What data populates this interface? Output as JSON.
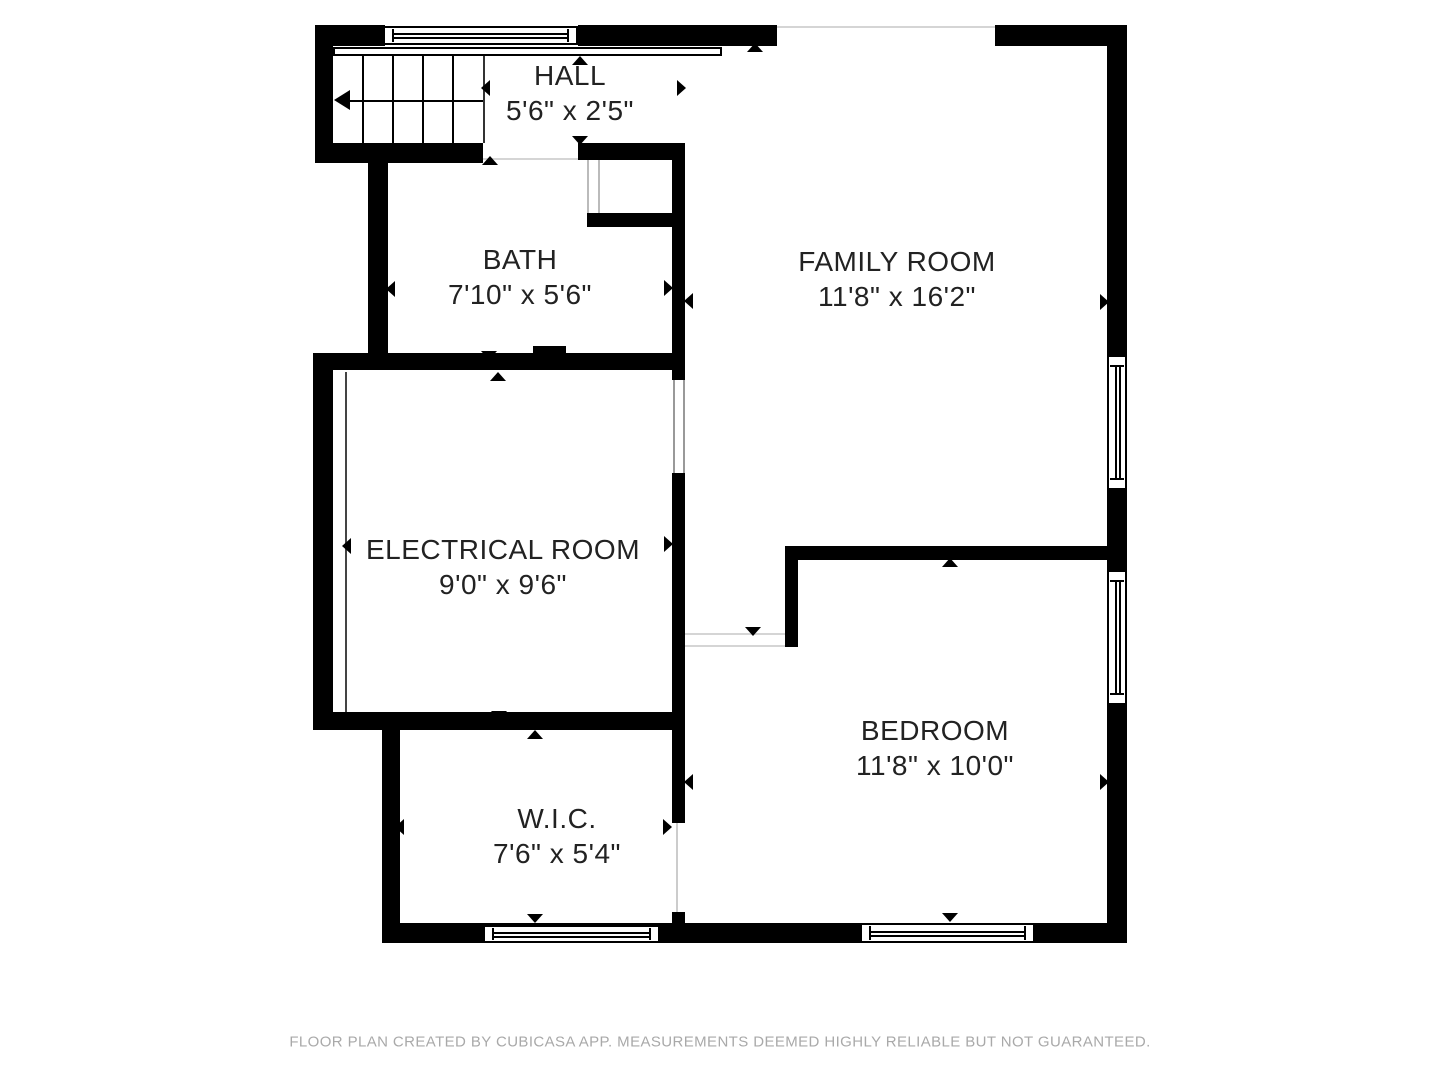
{
  "meta": {
    "wall_color": "#000000",
    "text_color": "#222222",
    "muted_text_color": "#a9a9a9",
    "faint_line_color": "#d5d5d5",
    "frame_line_color": "#999999",
    "background": "#ffffff"
  },
  "footer": {
    "text": "FLOOR PLAN CREATED BY CUBICASA APP. MEASUREMENTS DEEMED HIGHLY RELIABLE BUT NOT GUARANTEED."
  },
  "rooms": [
    {
      "id": "hall",
      "name": "HALL",
      "dims": "5'6\" x 2'5\"",
      "cx": 570,
      "cy": 93
    },
    {
      "id": "bath",
      "name": "BATH",
      "dims": "7'10\" x 5'6\"",
      "cx": 520,
      "cy": 277
    },
    {
      "id": "family-room",
      "name": "FAMILY ROOM",
      "dims": "11'8\" x 16'2\"",
      "cx": 897,
      "cy": 279
    },
    {
      "id": "electrical-room",
      "name": "ELECTRICAL ROOM",
      "dims": "9'0\" x 9'6\"",
      "cx": 503,
      "cy": 567
    },
    {
      "id": "bedroom",
      "name": "BEDROOM",
      "dims": "11'8\" x 10'0\"",
      "cx": 935,
      "cy": 748
    },
    {
      "id": "wic",
      "name": "W.I.C.",
      "dims": "7'6\" x 5'4\"",
      "cx": 557,
      "cy": 836
    }
  ],
  "walls": [
    [
      315,
      25,
      70,
      21
    ],
    [
      578,
      25,
      199,
      21
    ],
    [
      995,
      25,
      132,
      21
    ],
    [
      1107,
      25,
      20,
      330
    ],
    [
      1107,
      490,
      20,
      80
    ],
    [
      1107,
      705,
      20,
      238
    ],
    [
      382,
      923,
      745,
      20
    ],
    [
      315,
      25,
      18,
      138
    ],
    [
      315,
      143,
      168,
      20
    ],
    [
      368,
      143,
      20,
      227
    ],
    [
      313,
      353,
      364,
      17
    ],
    [
      313,
      353,
      20,
      377
    ],
    [
      313,
      712,
      364,
      18
    ],
    [
      382,
      718,
      18,
      225
    ],
    [
      578,
      143,
      107,
      17
    ],
    [
      587,
      213,
      90,
      14
    ],
    [
      672,
      145,
      13,
      235
    ],
    [
      672,
      473,
      13,
      350
    ],
    [
      672,
      912,
      13,
      11
    ],
    [
      785,
      546,
      322,
      14
    ],
    [
      785,
      546,
      13,
      101
    ],
    [
      533,
      346,
      33,
      16
    ]
  ],
  "windows": [
    {
      "rect": [
        383,
        26,
        195,
        19
      ],
      "orient": "h"
    },
    {
      "rect": [
        1107,
        355,
        20,
        135
      ],
      "orient": "v"
    },
    {
      "rect": [
        1107,
        570,
        20,
        135
      ],
      "orient": "v"
    },
    {
      "rect": [
        860,
        923,
        175,
        20
      ],
      "orient": "h"
    },
    {
      "rect": [
        483,
        925,
        177,
        18
      ],
      "orient": "h"
    }
  ],
  "thin_lines": [
    {
      "rect": [
        777,
        26,
        218,
        2
      ],
      "color": "#d5d5d5"
    },
    {
      "rect": [
        483,
        158,
        95,
        2
      ],
      "color": "#d5d5d5"
    },
    {
      "rect": [
        587,
        160,
        2,
        53
      ],
      "color": "#bbbbbb"
    },
    {
      "rect": [
        598,
        160,
        2,
        53
      ],
      "color": "#bbbbbb"
    },
    {
      "rect": [
        673,
        380,
        2,
        93
      ],
      "color": "#999999"
    },
    {
      "rect": [
        683,
        380,
        2,
        93
      ],
      "color": "#999999"
    },
    {
      "rect": [
        685,
        633,
        100,
        2
      ],
      "color": "#d5d5d5"
    },
    {
      "rect": [
        685,
        645,
        100,
        2
      ],
      "color": "#d5d5d5"
    },
    {
      "rect": [
        676,
        823,
        2,
        89
      ],
      "color": "#cccccc"
    },
    {
      "rect": [
        345,
        372,
        2,
        340
      ],
      "color": "#444444"
    },
    {
      "rect": [
        483,
        56,
        2,
        87
      ],
      "color": "#333333"
    }
  ],
  "railing": {
    "rect": [
      333,
      47,
      389,
      9
    ]
  },
  "stairs": {
    "region": [
      333,
      56,
      150,
      87
    ],
    "tread_x": [
      362,
      392,
      422,
      452
    ],
    "arrow_line": {
      "x1": 345,
      "x2": 483,
      "y": 100
    },
    "arrowhead": {
      "x": 334,
      "y": 90
    }
  },
  "arrows": [
    {
      "x": 580,
      "y": 61,
      "dir": "up"
    },
    {
      "x": 486,
      "y": 88,
      "dir": "left"
    },
    {
      "x": 682,
      "y": 88,
      "dir": "right"
    },
    {
      "x": 580,
      "y": 141,
      "dir": "down"
    },
    {
      "x": 755,
      "y": 48,
      "dir": "up"
    },
    {
      "x": 490,
      "y": 161,
      "dir": "up"
    },
    {
      "x": 391,
      "y": 289,
      "dir": "left"
    },
    {
      "x": 669,
      "y": 288,
      "dir": "right"
    },
    {
      "x": 489,
      "y": 356,
      "dir": "down"
    },
    {
      "x": 689,
      "y": 301,
      "dir": "left"
    },
    {
      "x": 1105,
      "y": 302,
      "dir": "right"
    },
    {
      "x": 753,
      "y": 632,
      "dir": "down"
    },
    {
      "x": 498,
      "y": 377,
      "dir": "up"
    },
    {
      "x": 347,
      "y": 546,
      "dir": "left"
    },
    {
      "x": 669,
      "y": 544,
      "dir": "right"
    },
    {
      "x": 499,
      "y": 716,
      "dir": "down"
    },
    {
      "x": 535,
      "y": 735,
      "dir": "up"
    },
    {
      "x": 400,
      "y": 827,
      "dir": "left"
    },
    {
      "x": 668,
      "y": 827,
      "dir": "right"
    },
    {
      "x": 535,
      "y": 919,
      "dir": "down"
    },
    {
      "x": 950,
      "y": 563,
      "dir": "up"
    },
    {
      "x": 689,
      "y": 782,
      "dir": "left"
    },
    {
      "x": 1105,
      "y": 782,
      "dir": "right"
    },
    {
      "x": 950,
      "y": 918,
      "dir": "down"
    }
  ]
}
